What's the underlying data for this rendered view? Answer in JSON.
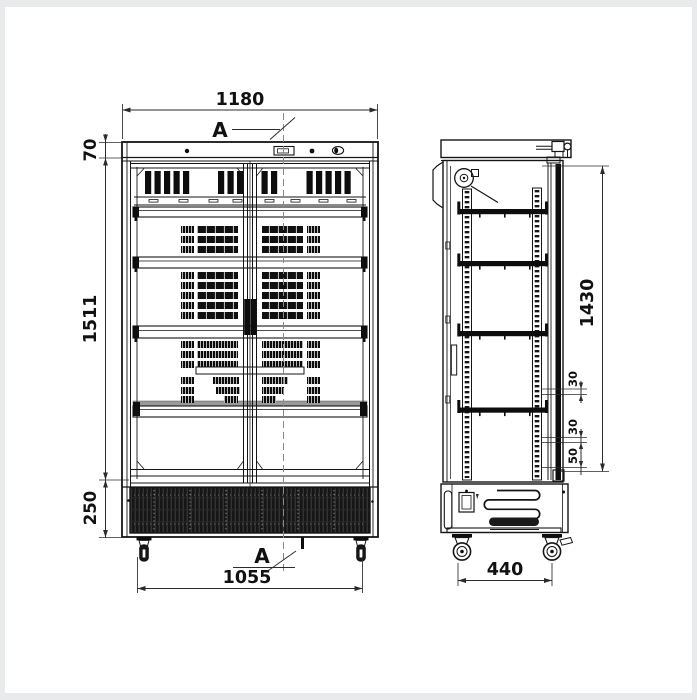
{
  "page": {
    "background": "#e9eaec",
    "canvas": "#ffffff"
  },
  "drawing": {
    "subject": "Double glass door display refrigerator - dimensional technical drawing, front and side views",
    "front_view": {
      "overall_width": "1180",
      "canopy_height": "70",
      "body_height": "1511",
      "base_height": "250",
      "wheelbase_width": "1055",
      "section_marker_top": "A",
      "section_marker_bottom": "A"
    },
    "side_view": {
      "wheelbase_depth": "440",
      "door_height": "1430",
      "shelf_gap_upper": "30",
      "shelf_gap_lower": "30",
      "rail_bottom_gap": "50"
    },
    "colors": {
      "line": "#151515",
      "dimension": "#2b2b2b",
      "dark_fill": "#0d0d0d",
      "shelf_accent_gray": "#9a9a9a",
      "centerline_gray": "#888888",
      "page_frame": "#e9eaec"
    }
  }
}
